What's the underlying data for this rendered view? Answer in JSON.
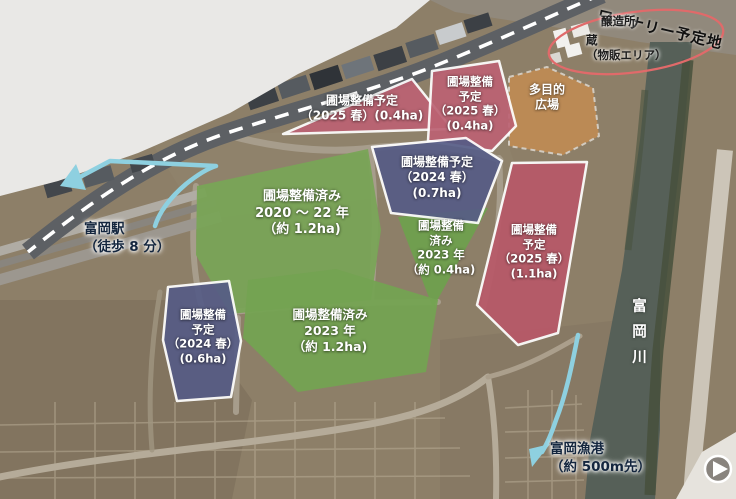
{
  "map": {
    "annotations": {
      "winery_site": "ワイナリー予定地",
      "brewery": "醸造所",
      "storehouse": "蔵\n（物販エリア）",
      "station": "富岡駅\n（徒歩 8 分）",
      "river": "富岡川",
      "fishing_port": "富岡漁港\n（約 500m先）"
    },
    "fields": [
      {
        "id": "pink-top",
        "label": "圃場整備予定\n（2025 春）(0.4ha)",
        "color": "#bc6273"
      },
      {
        "id": "pink-top-right",
        "label": "圃場整備\n予定\n（2025 春）\n(0.4ha)",
        "color": "#bc6273"
      },
      {
        "id": "purple-mid",
        "label": "圃場整備予定\n（2024 春）\n(0.7ha)",
        "color": "#565c86"
      },
      {
        "id": "green-large",
        "label": "圃場整備済み\n2020 ～ 22 年\n（約 1.2ha)",
        "color": "#79a457"
      },
      {
        "id": "green-mid",
        "label": "圃場整備\n済み\n2023 年\n（約 0.4ha)",
        "color": "#6fa04e"
      },
      {
        "id": "red-right",
        "label": "圃場整備\n予定\n（2025 春）\n(1.1ha)",
        "color": "#b85868"
      },
      {
        "id": "purple-bottom-left",
        "label": "圃場整備\n予定\n（2024 春）\n(0.6ha)",
        "color": "#565c86"
      },
      {
        "id": "green-bottom",
        "label": "圃場整備済み\n2023 年\n（約 1.2ha)",
        "color": "#74a352"
      },
      {
        "id": "plaza",
        "label": "多目的\n広場",
        "color": "#bf8b54"
      }
    ],
    "colors": {
      "planned_red": "#bc6273",
      "planned_purple": "#565c86",
      "completed_green": "#74a352",
      "plaza_orange": "#bf8b54",
      "route_cyan": "#8ed0e0",
      "highlight_ellipse": "#e06a6a",
      "label_navy": "#14263e"
    },
    "icons": {
      "next_arrow_icon": "▶"
    }
  }
}
